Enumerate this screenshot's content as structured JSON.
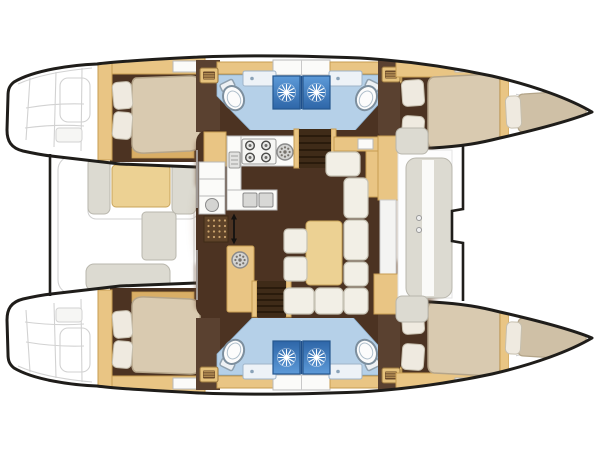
{
  "meta": {
    "kind": "floorplan-diagram",
    "subject": "catamaran-yacht-interior-layout-top-view",
    "orientation": "bow-right-stern-left"
  },
  "colors": {
    "background": "#ffffff",
    "hull_fill": "#ffffff",
    "hull_outline": "#1f1d1a",
    "exterior_line": "#d2d2d2",
    "deck_shadow": "#7b5c43",
    "deck_shadow_light": "#9a7b5c",
    "floor_dark": "#4c3322",
    "wall_brown": "#5a4130",
    "wood_tan": "#e9c584",
    "wood_tan_dark": "#d9ae66",
    "wood_border": "#c79d52",
    "mattress": "#d9cab0",
    "mattress_dark": "#cfc0a6",
    "mattress_border": "#b5a58a",
    "pillow": "#efeae0",
    "bath_floor": "#b5d0e8",
    "vanity": "#edf2f7",
    "shower_blue_light": "#5d9ad8",
    "shower_blue_dark": "#2e66a8",
    "settee": "#f2efe6",
    "seat_grey": "#dcdad1",
    "counter_white": "#fbfbf9",
    "steps_brown": "#3f2b18",
    "table_tan": "#ecd193",
    "grate_brown": "#5e4329",
    "grate_dot": "#caa36d"
  },
  "icons": [
    {
      "name": "shower-jet-icon",
      "shape": "white starburst on blue tile"
    },
    {
      "name": "toilet-icon",
      "shape": "oval bowl with cistern"
    },
    {
      "name": "sink-round-icon",
      "shape": "circle with ring of drain holes"
    },
    {
      "name": "sink-square-icon",
      "shape": "double square basins"
    },
    {
      "name": "stove-burner-icon",
      "shape": "ring with center dot, 2x2 grid"
    },
    {
      "name": "hatch-steps-icon",
      "shape": "tan plate with dark rungs"
    },
    {
      "name": "entry-arrow-icon",
      "shape": "double-headed vertical arrow"
    }
  ],
  "regions": [
    "port-transom-steps",
    "starboard-transom-steps",
    "aft-cockpit",
    "port-aft-cabin",
    "port-heads",
    "port-forward-cabin",
    "port-forepeak-berth",
    "starboard-aft-cabin",
    "starboard-heads",
    "starboard-forward-cabin",
    "starboard-forepeak-berth",
    "salon-galley",
    "salon-dinette",
    "companionway-stairs-port",
    "companionway-stairs-starboard",
    "forward-cockpit",
    "trampoline"
  ]
}
